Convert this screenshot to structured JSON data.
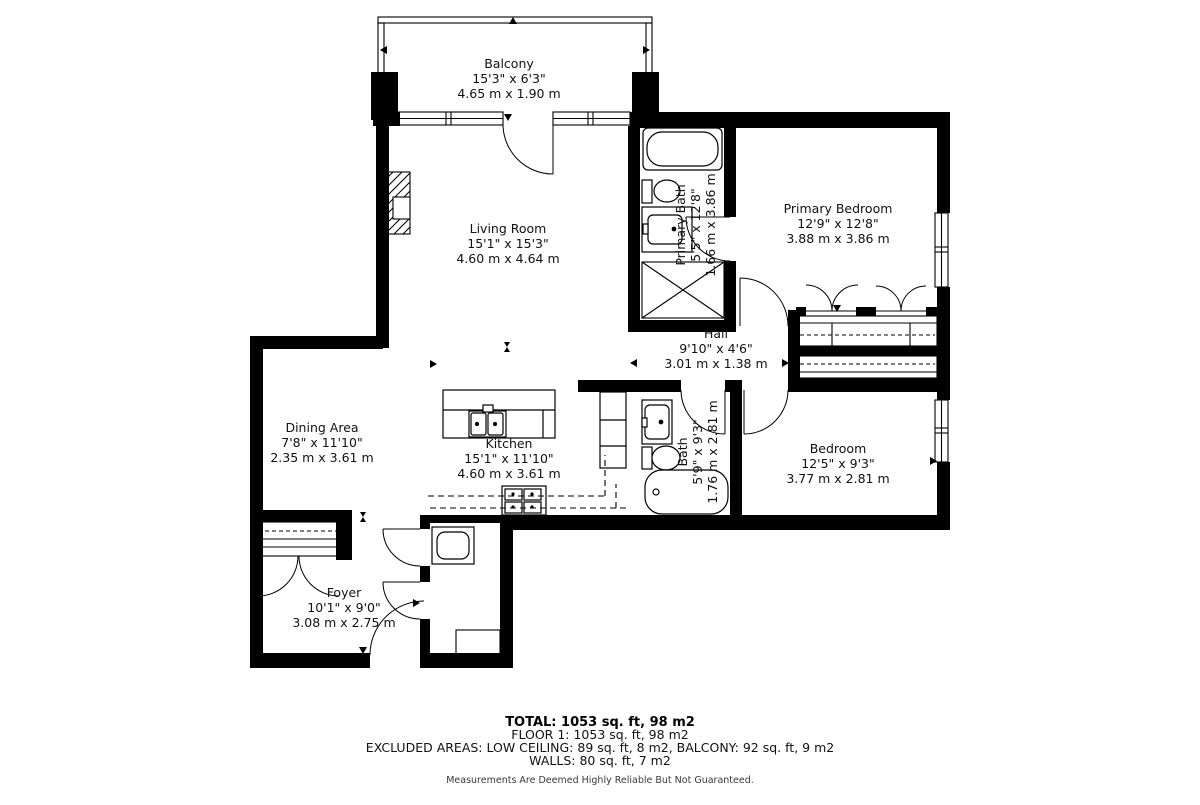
{
  "floor_plan": {
    "rooms": [
      {
        "name": "Balcony",
        "dims_ft": "15'3\" x 6'3\"",
        "dims_m": "4.65 m x 1.90 m"
      },
      {
        "name": "Living Room",
        "dims_ft": "15'1\" x 15'3\"",
        "dims_m": "4.60 m x 4.64 m"
      },
      {
        "name": "Primary Bath",
        "dims_ft": "5'5\" x 12'8\"",
        "dims_m": "1.66 m x 3.86 m"
      },
      {
        "name": "Primary Bedroom",
        "dims_ft": "12'9\" x 12'8\"",
        "dims_m": "3.88 m x 3.86 m"
      },
      {
        "name": "Hall",
        "dims_ft": "9'10\" x 4'6\"",
        "dims_m": "3.01 m x 1.38 m"
      },
      {
        "name": "Dining Area",
        "dims_ft": "7'8\" x 11'10\"",
        "dims_m": "2.35 m x 3.61 m"
      },
      {
        "name": "Kitchen",
        "dims_ft": "15'1\" x 11'10\"",
        "dims_m": "4.60 m x 3.61 m"
      },
      {
        "name": "Bath",
        "dims_ft": "5'9\" x 9'3\"",
        "dims_m": "1.76 m x 2.81 m"
      },
      {
        "name": "Bedroom",
        "dims_ft": "12'5\" x 9'3\"",
        "dims_m": "3.77 m x 2.81 m"
      },
      {
        "name": "Foyer",
        "dims_ft": "10'1\" x 9'0\"",
        "dims_m": "3.08 m x 2.75 m"
      }
    ],
    "summary": {
      "total": "TOTAL: 1053 sq. ft, 98 m2",
      "floor": "FLOOR 1: 1053 sq. ft, 98 m2",
      "excluded": "EXCLUDED AREAS: LOW CEILING: 89 sq. ft, 8 m2, BALCONY: 92 sq. ft, 9 m2",
      "walls": "WALLS: 80 sq. ft, 7 m2",
      "disclaimer": "Measurements Are Deemed Highly Reliable But Not Guaranteed."
    },
    "colors": {
      "wall": "#000000",
      "line": "#1a1a1a",
      "text": "#111111",
      "disclaimer": "#3a3a3a"
    }
  }
}
